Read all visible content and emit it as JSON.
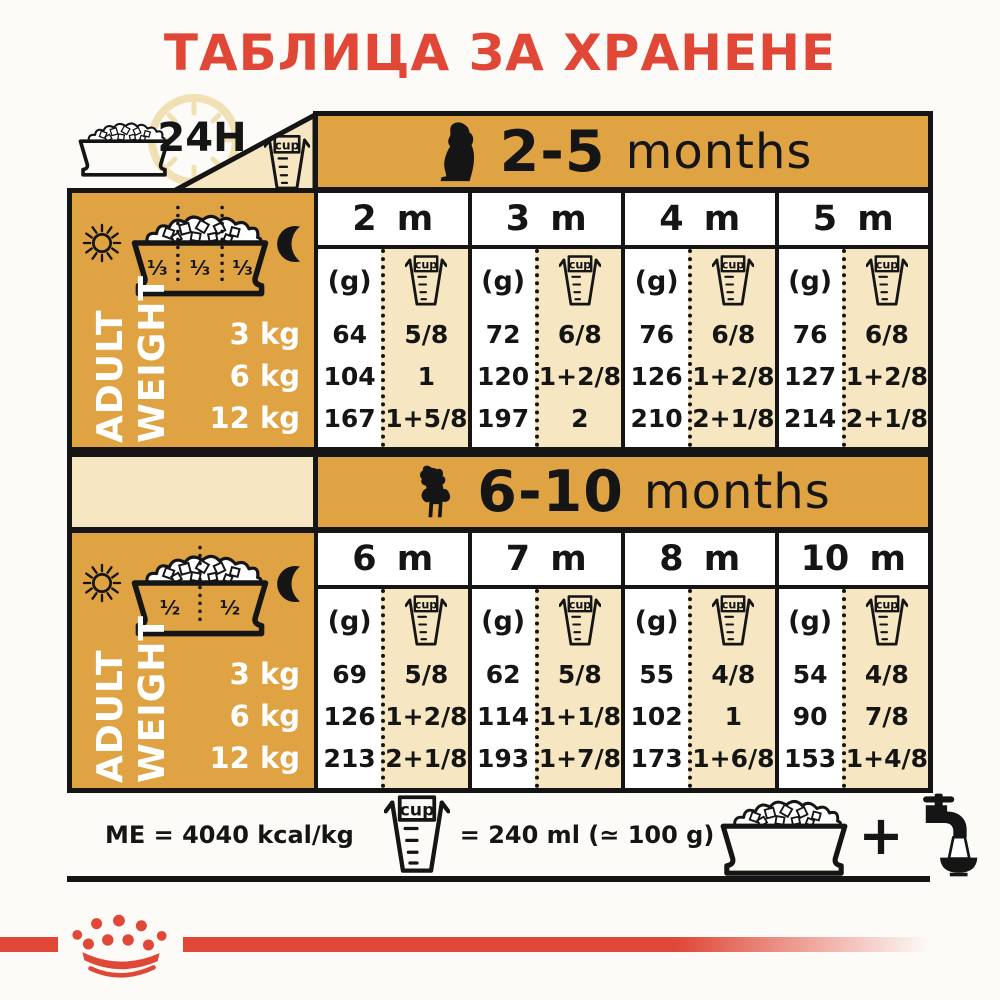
{
  "title": {
    "text": "ТАБЛИЦА ЗА ХРАНЕНЕ"
  },
  "colors": {
    "gold": "#E0A344",
    "cream": "#F6E7C2",
    "red": "#E04737",
    "black": "#151515"
  },
  "labels": {
    "around_clock": "24H",
    "cup": "cup",
    "grams": "(g)",
    "plus": "+"
  },
  "tables": [
    {
      "age_range": "2-5",
      "age_unit": "months",
      "dog_icon": "puppy-silhouette",
      "bowl_fractions": [
        "⅓",
        "⅓",
        "⅓"
      ],
      "side_label": {
        "line1": "ADULT",
        "line2": "WEIGHT"
      },
      "weights": [
        "3 kg",
        "6 kg",
        "12 kg"
      ],
      "columns": [
        {
          "month": "2 m",
          "grams": [
            "64",
            "104",
            "167"
          ],
          "cups": [
            "5/8",
            "1",
            "1+5/8"
          ]
        },
        {
          "month": "3 m",
          "grams": [
            "72",
            "120",
            "197"
          ],
          "cups": [
            "6/8",
            "1+2/8",
            "2"
          ]
        },
        {
          "month": "4 m",
          "grams": [
            "76",
            "126",
            "210"
          ],
          "cups": [
            "6/8",
            "1+2/8",
            "2+1/8"
          ]
        },
        {
          "month": "5 m",
          "grams": [
            "76",
            "127",
            "214"
          ],
          "cups": [
            "6/8",
            "1+2/8",
            "2+1/8"
          ]
        }
      ]
    },
    {
      "age_range": "6-10",
      "age_unit": "months",
      "dog_icon": "poodle-silhouette",
      "bowl_fractions": [
        "½",
        "½"
      ],
      "side_label": {
        "line1": "ADULT",
        "line2": "WEIGHT"
      },
      "weights": [
        "3 kg",
        "6 kg",
        "12 kg"
      ],
      "columns": [
        {
          "month": "6 m",
          "grams": [
            "69",
            "126",
            "213"
          ],
          "cups": [
            "5/8",
            "1+2/8",
            "2+1/8"
          ]
        },
        {
          "month": "7 m",
          "grams": [
            "62",
            "114",
            "193"
          ],
          "cups": [
            "5/8",
            "1+1/8",
            "1+7/8"
          ]
        },
        {
          "month": "8 m",
          "grams": [
            "55",
            "102",
            "173"
          ],
          "cups": [
            "4/8",
            "1",
            "1+6/8"
          ]
        },
        {
          "month": "10 m",
          "grams": [
            "54",
            "90",
            "153"
          ],
          "cups": [
            "4/8",
            "7/8",
            "1+4/8"
          ]
        }
      ]
    }
  ],
  "footer": {
    "me": "ME = 4040 kcal/kg",
    "cup_equiv": "= 240 ml (≃ 100 g)"
  }
}
